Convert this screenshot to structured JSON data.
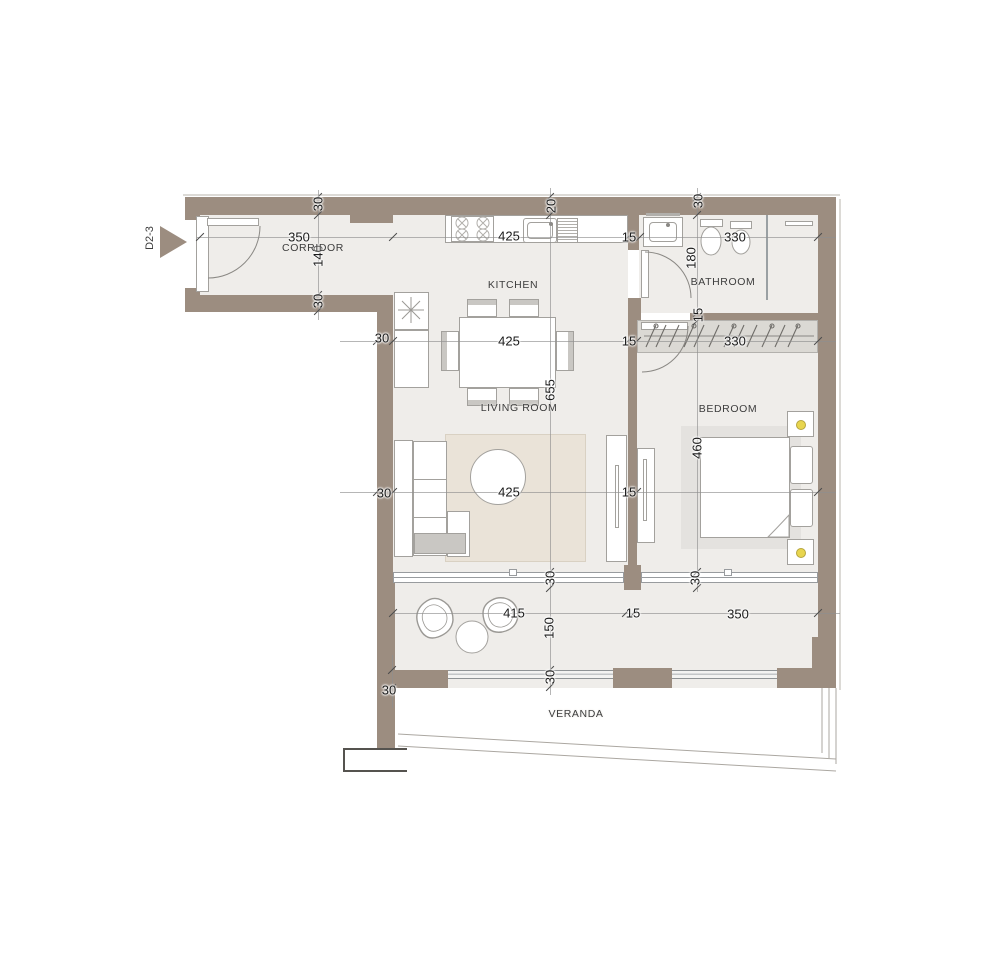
{
  "unit": {
    "label": "D2-3"
  },
  "rooms": {
    "corridor": "CORRIDOR",
    "kitchen": "KITCHEN",
    "bathroom": "BATHROOM",
    "living_room": "LIVING ROOM",
    "bedroom": "BEDROOM",
    "veranda": "VERANDA"
  },
  "dims": {
    "wall_top_corridor": "30",
    "corridor_width": "350",
    "corridor_depth": "140",
    "wall_corridor_bottom": "30",
    "counter_width": "425",
    "wall_top_kitchen": "20",
    "kitchen_bath_wall": "15",
    "bathroom_width": "330",
    "wall_top_bathroom": "30",
    "bathroom_depth": "180",
    "bathroom_wall_bottom": "15",
    "wall_left_upper": "30",
    "dining_width": "425",
    "partition_upper": "15",
    "wardrobe_width": "330",
    "living_length": "655",
    "bedroom_depth": "460",
    "wall_left_lower": "30",
    "living_width": "425",
    "partition_lower": "15",
    "window_wall_living": "30",
    "window_wall_bedroom": "30",
    "balcony_width_left": "415",
    "balcony_depth": "150",
    "balcony_wall_mid": "15",
    "balcony_width_right": "350",
    "railing_wall": "30",
    "balcony_wall_left": "30"
  },
  "colors": {
    "wall": "#9c8d80",
    "floor": "#efedea",
    "rug_living": "#eae3d8",
    "rug_bedroom": "#e4e2df",
    "wardrobe_fill": "#dbd9d4",
    "lamp": "#e8d54e",
    "text": "#1b1b1b"
  }
}
